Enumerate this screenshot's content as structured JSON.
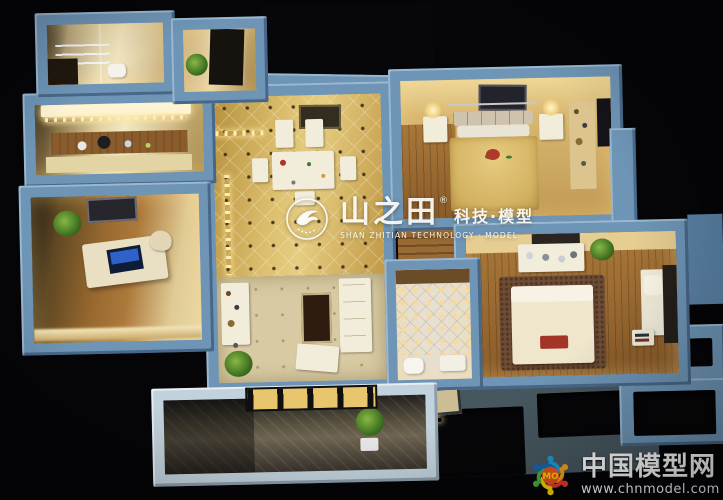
{
  "watermarks": {
    "center": {
      "brand": "山之田",
      "reg_mark": "®",
      "tagline": "科技·模型",
      "subtitle": "SHAN ZHITIAN TECHNOLOGY · MODEL"
    },
    "corner": {
      "logo_text": "MO",
      "site_name": "中国模型网",
      "site_url": "www.chnmodel.com"
    }
  },
  "icons": {
    "center_logo": "shanzhitian-bird-logo",
    "corner_logo": "chnmodel-dancing-figures-logo"
  },
  "colors": {
    "background": "#050508",
    "model_wall_blue": "#6e95b6",
    "model_wall_shadow": "#3f6288",
    "floor_tile_gold": "#c9a855",
    "floor_wood": "#9a6a34",
    "interior_glow": "#ffe9b0",
    "balcony_frame": "#c2d2dc",
    "corner_logo_center": "#e8541e",
    "corner_logo_text_color": "#ffd200"
  }
}
